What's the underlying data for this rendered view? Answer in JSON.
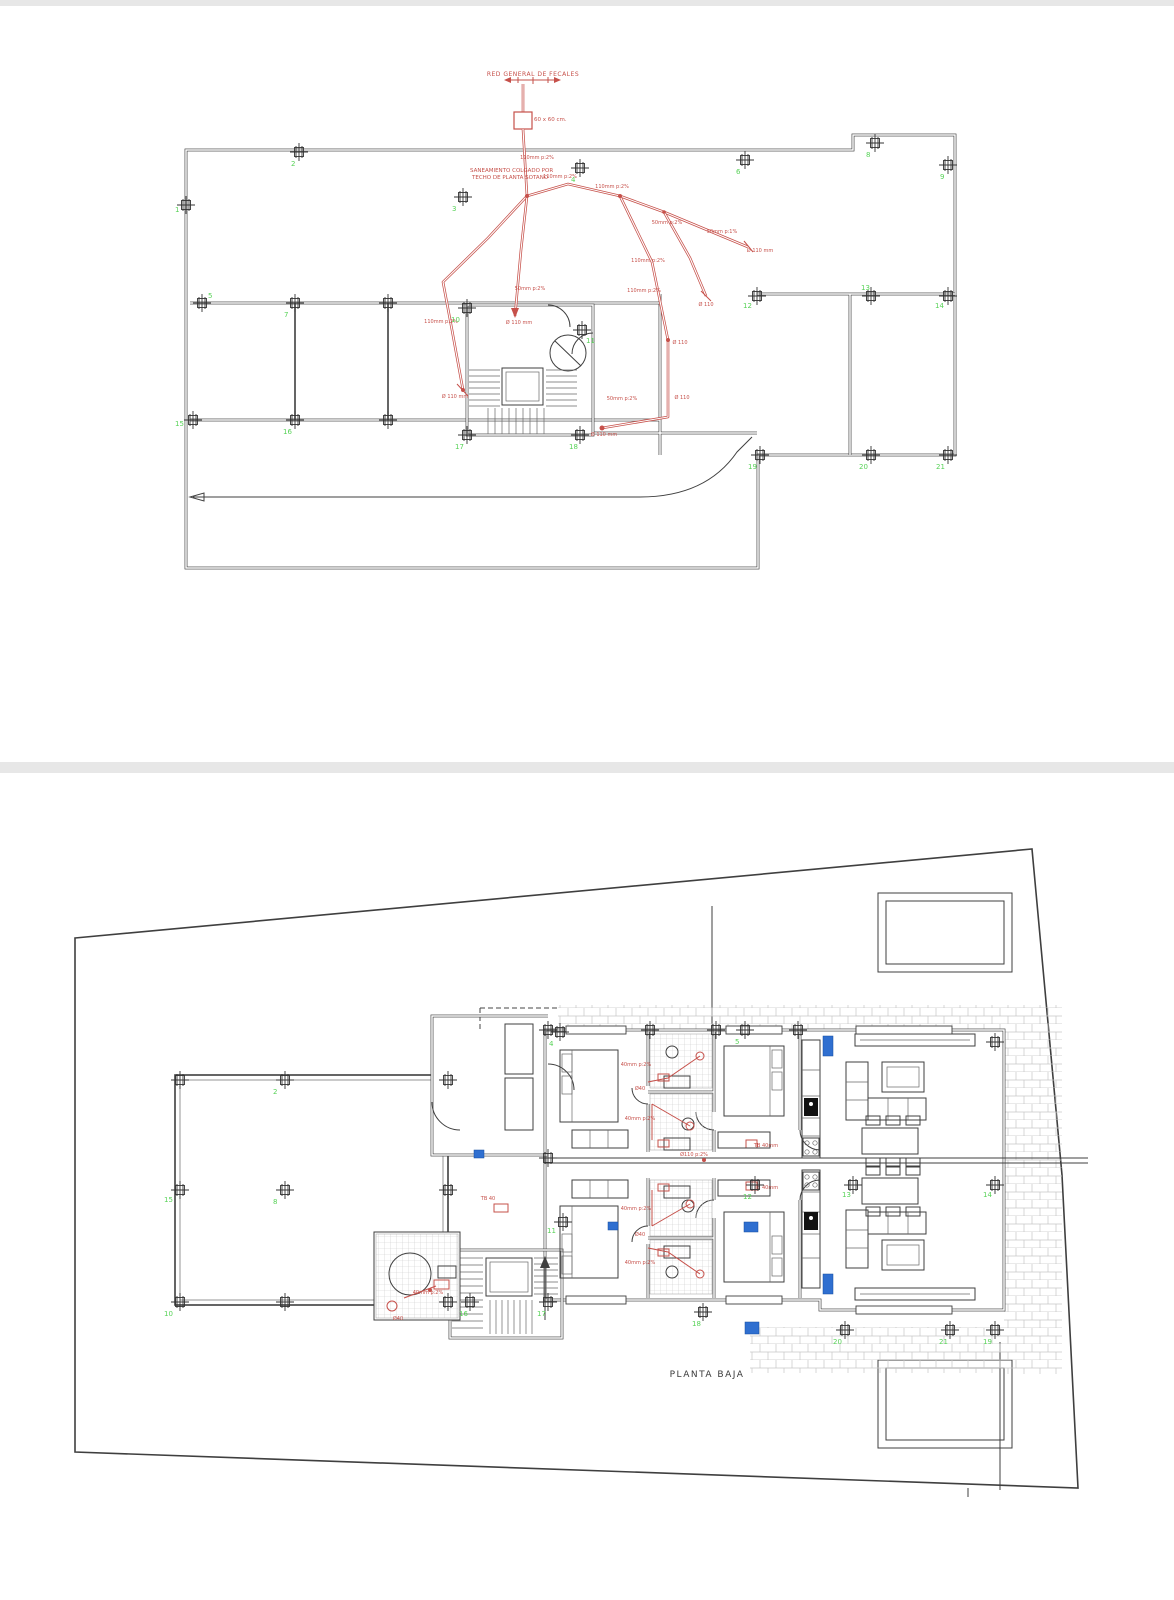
{
  "colors": {
    "line": "#3f3f3f",
    "pipe_red": "#c6504a",
    "column_green": "#57d257",
    "accent_blue": "#2f6fd0",
    "tile_gray": "#c9c9c9",
    "divider_gray": "#e7e7e7"
  },
  "top_plan": {
    "header_label": "RED GENERAL DE FECALES",
    "arqueta_label": "60 x 60 cm.",
    "note_line1": "SANEAMIENTO COLGADO POR",
    "note_line2": "TECHO DE PLANTA SOTANO",
    "pipe_labels": [
      {
        "x": 537,
        "y": 159,
        "t": "110mm p:2%"
      },
      {
        "x": 560,
        "y": 178,
        "t": "110mm p:2%"
      },
      {
        "x": 612,
        "y": 188,
        "t": "110mm p:2%"
      },
      {
        "x": 667,
        "y": 224,
        "t": "50mm p:2%"
      },
      {
        "x": 722,
        "y": 233,
        "t": "50mm p:1%"
      },
      {
        "x": 760,
        "y": 252,
        "t": "Ø 110 mm"
      },
      {
        "x": 648,
        "y": 262,
        "t": "110mm p:2%"
      },
      {
        "x": 530,
        "y": 290,
        "t": "50mm p:2%"
      },
      {
        "x": 441,
        "y": 323,
        "t": "110mm p:2%"
      },
      {
        "x": 519,
        "y": 324,
        "t": "Ø 110 mm"
      },
      {
        "x": 644,
        "y": 292,
        "t": "110mm p:2%"
      },
      {
        "x": 680,
        "y": 344,
        "t": "Ø 110"
      },
      {
        "x": 622,
        "y": 400,
        "t": "50mm p:2%"
      },
      {
        "x": 682,
        "y": 399,
        "t": "Ø 110"
      },
      {
        "x": 455,
        "y": 398,
        "t": "Ø 110 mm"
      },
      {
        "x": 604,
        "y": 436,
        "t": "Ø 110 mm"
      },
      {
        "x": 706,
        "y": 306,
        "t": "Ø 110"
      }
    ],
    "columns": [
      {
        "n": "1",
        "x": 186,
        "y": 205,
        "lx": 175,
        "ly": 212
      },
      {
        "n": "2",
        "x": 299,
        "y": 152,
        "lx": 291,
        "ly": 166
      },
      {
        "n": "3",
        "x": 463,
        "y": 197,
        "lx": 452,
        "ly": 211
      },
      {
        "n": "4",
        "x": 580,
        "y": 168,
        "lx": 571,
        "ly": 182
      },
      {
        "n": "5",
        "x": 202,
        "y": 303,
        "lx": 208,
        "ly": 298
      },
      {
        "n": "6",
        "x": 745,
        "y": 160,
        "lx": 736,
        "ly": 174
      },
      {
        "n": "7",
        "x": 295,
        "y": 303,
        "lx": 284,
        "ly": 317
      },
      {
        "n": "8",
        "x": 875,
        "y": 143,
        "lx": 866,
        "ly": 157
      },
      {
        "n": "9",
        "x": 948,
        "y": 165,
        "lx": 940,
        "ly": 179
      },
      {
        "n": "10",
        "x": 467,
        "y": 308,
        "lx": 451,
        "ly": 322
      },
      {
        "n": "11",
        "x": 582,
        "y": 330,
        "lx": 586,
        "ly": 343
      },
      {
        "n": "12",
        "x": 757,
        "y": 296,
        "lx": 743,
        "ly": 308
      },
      {
        "n": "13",
        "x": 871,
        "y": 296,
        "lx": 861,
        "ly": 290
      },
      {
        "n": "14",
        "x": 948,
        "y": 296,
        "lx": 935,
        "ly": 308
      },
      {
        "n": "15",
        "x": 193,
        "y": 420,
        "lx": 175,
        "ly": 426
      },
      {
        "n": "16",
        "x": 295,
        "y": 420,
        "lx": 283,
        "ly": 434
      },
      {
        "n": "17",
        "x": 467,
        "y": 435,
        "lx": 455,
        "ly": 449
      },
      {
        "n": "18",
        "x": 580,
        "y": 435,
        "lx": 569,
        "ly": 449
      },
      {
        "n": "19",
        "x": 760,
        "y": 455,
        "lx": 748,
        "ly": 469
      },
      {
        "n": "20",
        "x": 871,
        "y": 455,
        "lx": 859,
        "ly": 469
      },
      {
        "n": "21",
        "x": 948,
        "y": 455,
        "lx": 936,
        "ly": 469
      },
      {
        "n": "",
        "x": 388,
        "y": 303
      },
      {
        "n": "",
        "x": 388,
        "y": 420
      }
    ]
  },
  "bottom_plan": {
    "title": "PLANTA BAJA",
    "pipe_labels": [
      {
        "x": 636,
        "y": 1066,
        "t": "40mm p:2%"
      },
      {
        "x": 640,
        "y": 1090,
        "t": "Ø40"
      },
      {
        "x": 640,
        "y": 1120,
        "t": "40mm p:2%"
      },
      {
        "x": 766,
        "y": 1147,
        "t": "TB 40mm"
      },
      {
        "x": 694,
        "y": 1156,
        "t": "Ø110 p:2%"
      },
      {
        "x": 636,
        "y": 1210,
        "t": "40mm p:2%"
      },
      {
        "x": 640,
        "y": 1236,
        "t": "Ø40"
      },
      {
        "x": 640,
        "y": 1264,
        "t": "40mm p:2%"
      },
      {
        "x": 766,
        "y": 1189,
        "t": "TB 40mm"
      },
      {
        "x": 428,
        "y": 1294,
        "t": "40mm p:2%"
      },
      {
        "x": 398,
        "y": 1320,
        "t": "Ø40"
      },
      {
        "x": 488,
        "y": 1200,
        "t": "TB 40"
      }
    ],
    "columns": [
      {
        "n": "2",
        "x": 285,
        "y": 1080,
        "lx": 273,
        "ly": 1094
      },
      {
        "n": "4",
        "x": 560,
        "y": 1032,
        "lx": 549,
        "ly": 1046
      },
      {
        "n": "5",
        "x": 745,
        "y": 1030,
        "lx": 735,
        "ly": 1044
      },
      {
        "n": "8",
        "x": 285,
        "y": 1190,
        "lx": 273,
        "ly": 1204
      },
      {
        "n": "10",
        "x": 180,
        "y": 1302,
        "lx": 164,
        "ly": 1316
      },
      {
        "n": "11",
        "x": 563,
        "y": 1222,
        "lx": 547,
        "ly": 1233
      },
      {
        "n": "12",
        "x": 755,
        "y": 1185,
        "lx": 743,
        "ly": 1199
      },
      {
        "n": "13",
        "x": 853,
        "y": 1185,
        "lx": 842,
        "ly": 1197
      },
      {
        "n": "14",
        "x": 995,
        "y": 1185,
        "lx": 983,
        "ly": 1197
      },
      {
        "n": "15",
        "x": 180,
        "y": 1190,
        "lx": 164,
        "ly": 1202
      },
      {
        "n": "16",
        "x": 470,
        "y": 1302,
        "lx": 459,
        "ly": 1316
      },
      {
        "n": "17",
        "x": 548,
        "y": 1302,
        "lx": 537,
        "ly": 1316
      },
      {
        "n": "18",
        "x": 703,
        "y": 1312,
        "lx": 692,
        "ly": 1326
      },
      {
        "n": "19",
        "x": 995,
        "y": 1330,
        "lx": 983,
        "ly": 1344
      },
      {
        "n": "20",
        "x": 845,
        "y": 1330,
        "lx": 833,
        "ly": 1344
      },
      {
        "n": "21",
        "x": 950,
        "y": 1330,
        "lx": 939,
        "ly": 1344
      },
      {
        "n": "",
        "x": 180,
        "y": 1080
      },
      {
        "n": "",
        "x": 448,
        "y": 1080
      },
      {
        "n": "",
        "x": 448,
        "y": 1190
      },
      {
        "n": "",
        "x": 285,
        "y": 1302
      },
      {
        "n": "",
        "x": 448,
        "y": 1302
      },
      {
        "n": "",
        "x": 548,
        "y": 1030
      },
      {
        "n": "",
        "x": 650,
        "y": 1030
      },
      {
        "n": "",
        "x": 716,
        "y": 1030
      },
      {
        "n": "",
        "x": 798,
        "y": 1030
      },
      {
        "n": "",
        "x": 995,
        "y": 1042
      },
      {
        "n": "",
        "x": 548,
        "y": 1158
      }
    ]
  }
}
